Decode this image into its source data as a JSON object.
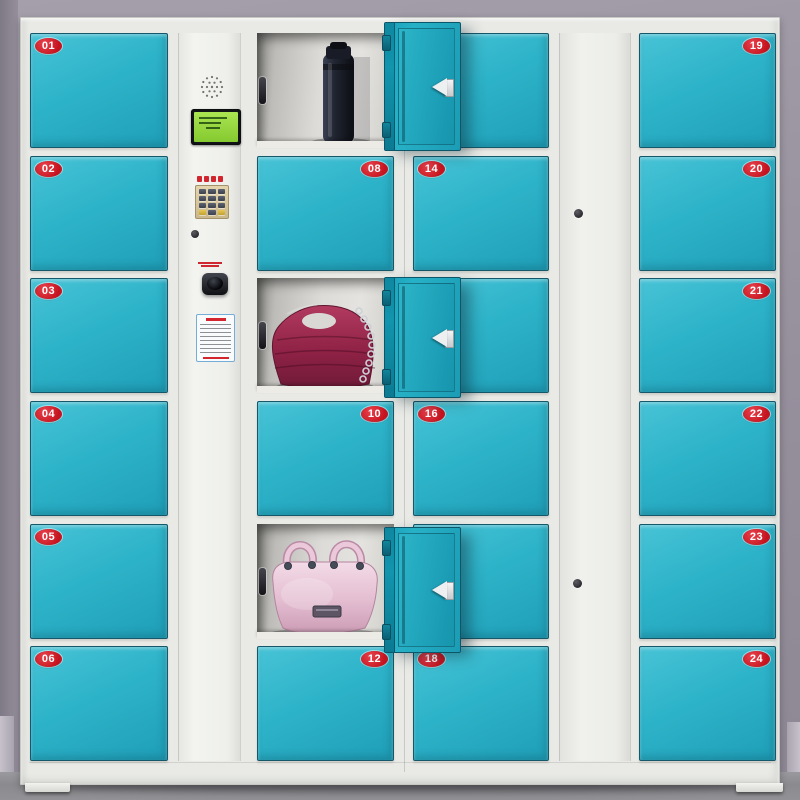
{
  "palette": {
    "door_teal": "#2ab3c9",
    "open_door_teal": "#1ca4bc",
    "frame_white": "#e9eae6",
    "badge_red": "#c5141f",
    "wall_gray": "#968f9c",
    "floor_gray": "#8b8a8e",
    "lcd_green": "#96d93c",
    "keypad_beige": "#d7c79f"
  },
  "locker_columns": [
    {
      "id": "A",
      "badge_side": "left",
      "lockers": [
        {
          "number": "01",
          "state": "closed"
        },
        {
          "number": "02",
          "state": "closed"
        },
        {
          "number": "03",
          "state": "closed"
        },
        {
          "number": "04",
          "state": "closed"
        },
        {
          "number": "05",
          "state": "closed"
        },
        {
          "number": "06",
          "state": "closed"
        }
      ]
    },
    {
      "id": "B",
      "badge_side": "right",
      "lockers": [
        {
          "number": "07",
          "state": "open",
          "badge_visible": false,
          "content": "black thermos bottle"
        },
        {
          "number": "08",
          "state": "closed"
        },
        {
          "number": "09",
          "state": "open",
          "badge_visible": false,
          "content": "dark pink quilted handbag with chain strap"
        },
        {
          "number": "10",
          "state": "closed"
        },
        {
          "number": "11",
          "state": "open",
          "badge_visible": false,
          "content": "light pink leather handbag"
        },
        {
          "number": "12",
          "state": "closed"
        }
      ]
    },
    {
      "id": "C",
      "badge_side": "left",
      "lockers": [
        {
          "number": "13",
          "state": "closed",
          "badge_visible": false
        },
        {
          "number": "14",
          "state": "closed"
        },
        {
          "number": "15",
          "state": "closed",
          "badge_visible": false
        },
        {
          "number": "16",
          "state": "closed"
        },
        {
          "number": "17",
          "state": "closed",
          "badge_visible": false
        },
        {
          "number": "18",
          "state": "closed"
        }
      ]
    },
    {
      "id": "D",
      "badge_side": "right",
      "lockers": [
        {
          "number": "19",
          "state": "closed"
        },
        {
          "number": "20",
          "state": "closed"
        },
        {
          "number": "21",
          "state": "closed"
        },
        {
          "number": "22",
          "state": "closed"
        },
        {
          "number": "23",
          "state": "closed"
        },
        {
          "number": "24",
          "state": "closed"
        }
      ]
    }
  ],
  "control_panel": {
    "components": [
      "speaker-grille",
      "lcd-display",
      "keypad",
      "key-lock",
      "barcode-scanner",
      "instruction-label"
    ]
  },
  "service_column": {
    "components": [
      "key-lock-upper",
      "key-lock-lower"
    ]
  }
}
